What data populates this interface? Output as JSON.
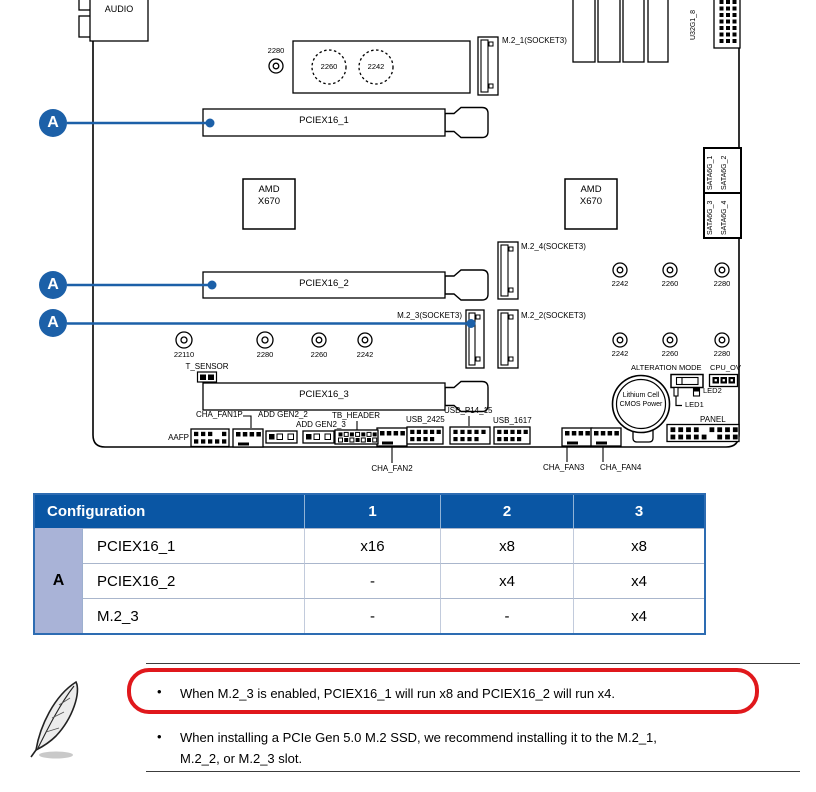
{
  "colors": {
    "callout_blue": "#1c60a8",
    "table_header_bg": "#0a56a4",
    "group_cell_bg": "#a9b3d7",
    "table_border": "#2d6cb2",
    "highlight_red": "#e0181c"
  },
  "board": {
    "audio": "AUDIO",
    "usb_header_vertical": "U32G1_8",
    "m2_1": "M.2_1(SOCKET3)",
    "m2_2": "M.2_2(SOCKET3)",
    "m2_3": "M.2_3(SOCKET3)",
    "m2_4": "M.2_4(SOCKET3)",
    "pciex16_1": "PCIEX16_1",
    "pciex16_2": "PCIEX16_2",
    "pciex16_3": "PCIEX16_3",
    "chipset": "AMD\nX670",
    "heatsink_circle_1": "2260",
    "heatsink_circle_2": "2242",
    "heatsink_standoff": "2280",
    "standoffs_right_upper": [
      "2242",
      "2260",
      "2280"
    ],
    "standoffs_right_lower": [
      "2242",
      "2260",
      "2280"
    ],
    "standoffs_left": [
      "22110",
      "2280",
      "2260",
      "2242"
    ],
    "sata_labels": [
      "SATA6G_1",
      "SATA6G_2",
      "SATA6G_3",
      "SATA6G_4"
    ],
    "t_sensor": "T_SENSOR",
    "battery": "Lithium Cell\nCMOS Power",
    "alteration_mode": "ALTERATION MODE",
    "cpu_ov": "CPU_OV",
    "led1": "LED1",
    "led2": "LED2",
    "panel": "PANEL",
    "aafp": "AAFP",
    "cha_fan1p": "CHA_FAN1P",
    "cha_fan2": "CHA_FAN2",
    "cha_fan3": "CHA_FAN3",
    "cha_fan4": "CHA_FAN4",
    "add_gen2_2": "ADD GEN2_2",
    "add_gen2_3": "ADD GEN2_3",
    "tb_header": "TB_HEADER",
    "usb_2425": "USB_2425",
    "usb_p14_15": "USB_P14_15",
    "usb_1617": "USB_1617",
    "callout_letter": "A"
  },
  "table": {
    "header": [
      "Configuration",
      "1",
      "2",
      "3"
    ],
    "group_label": "A",
    "rows": [
      {
        "label": "PCIEX16_1",
        "values": [
          "x16",
          "x8",
          "x8"
        ]
      },
      {
        "label": "PCIEX16_2",
        "values": [
          "-",
          "x4",
          "x4"
        ]
      },
      {
        "label": "M.2_3",
        "values": [
          "-",
          "-",
          "x4"
        ]
      }
    ]
  },
  "notes": {
    "bullet": "•",
    "items": [
      "When M.2_3 is enabled, PCIEX16_1 will run x8 and PCIEX16_2 will run x4.",
      "When installing a PCIe Gen 5.0 M.2 SSD, we recommend installing it to the M.2_1,\nM.2_2, or M.2_3 slot."
    ]
  }
}
